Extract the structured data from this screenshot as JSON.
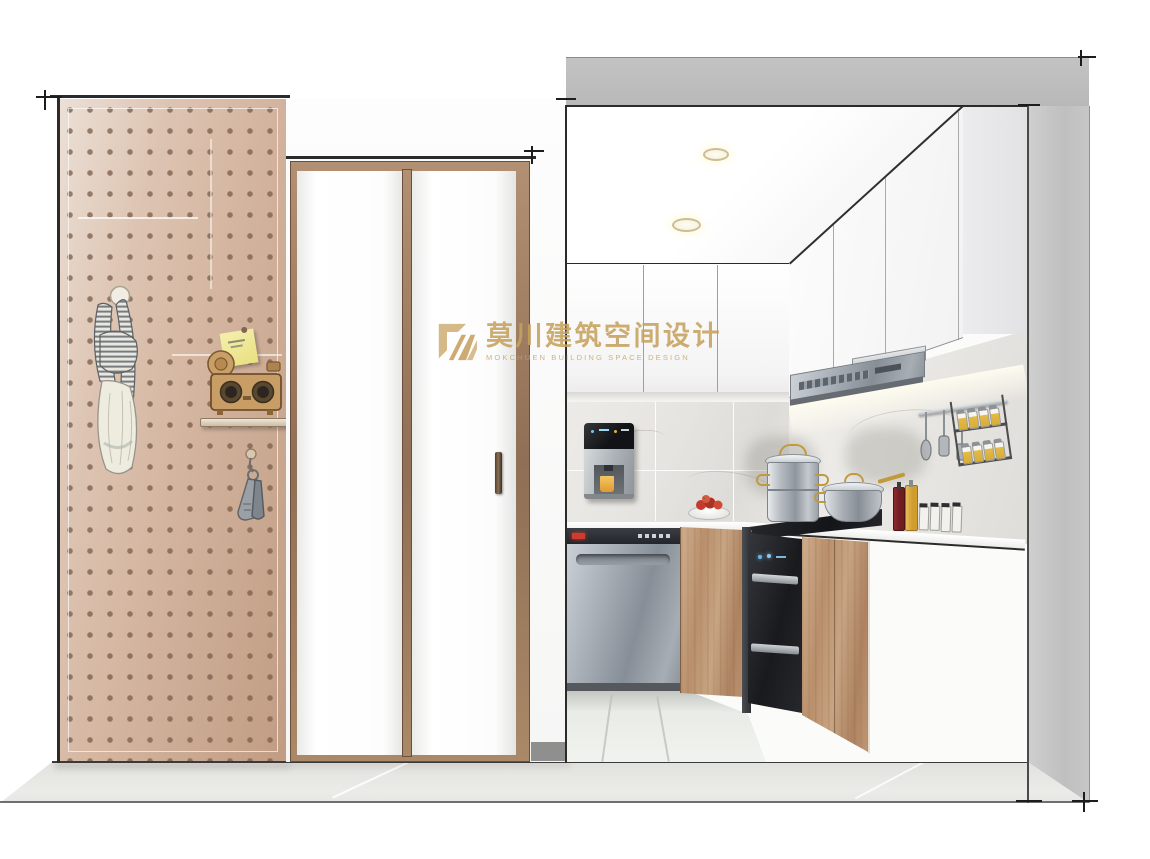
{
  "watermark": {
    "brand_zh": "莫川建筑空间设计",
    "brand_en": "MOKCHUEN BUILDING SPACE DESIGN",
    "color": "#c6a05f"
  },
  "palette": {
    "outside_wall_gray": "#bdbdbd",
    "pegboard_tan": "#d2b29c",
    "peg_dot_brown": "#8d7260",
    "door_frame_bronze": "#8f6f55",
    "cabinet_wood_light": "#b98f6c",
    "cabinet_wood_dark": "#8f6b4d",
    "stainless_steel": "#9aa1a9",
    "appliance_black": "#1c1e22",
    "display_red": "#d03a2f",
    "indicator_blue": "#6db4e8",
    "cup_orange": "#e8a435",
    "tomato_red": "#c23b2e",
    "spice_yellow": "#d8ac38",
    "backsplash_tile": "#e6e4e0",
    "floor_gray": "#e6e6e3",
    "brand_gold": "#c6a05f"
  },
  "scene": {
    "type": "interior-design-perspective-rendering",
    "room": "kitchen-and-entry",
    "objects": [
      "pegboard-accent-wall",
      "hanging-scarf",
      "sticky-note",
      "toy-camera-on-shelf",
      "hanging-keys",
      "bifold-door",
      "door-handle",
      "ceiling-downlights",
      "upper-wall-cabinets",
      "range-hood",
      "utensil-rail",
      "spice-rack",
      "water-purifier",
      "fruit-plate",
      "dishwasher",
      "disinfection-cabinet",
      "gas-cooktop",
      "stockpot",
      "saucepan",
      "condiment-bottles",
      "seasoning-jars",
      "base-cabinets",
      "countertop",
      "tile-floor"
    ]
  }
}
